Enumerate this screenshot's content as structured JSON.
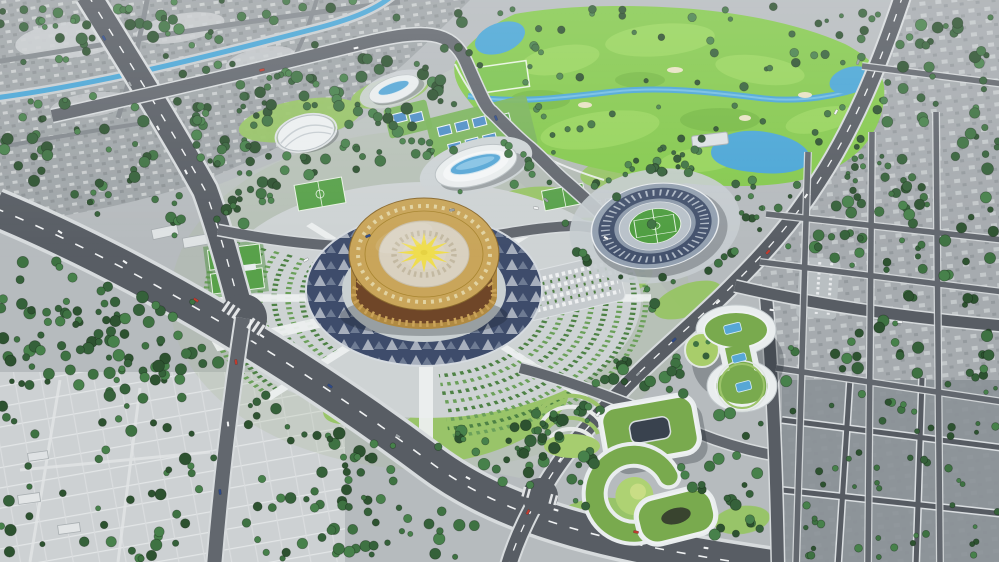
{
  "meta": {
    "kind": "aerial-architectural-render",
    "description": "Bird's-eye 3D masterplan render: central golden circular arena with sunburst roof on a radial plaza of arc-shaped tree gardens, athletics stadium, oval aquatics hall, golf course with stream and ponds, green-roof civic campus, wide boulevards, dense tree-lined city grid",
    "width": 999,
    "height": 562
  },
  "visible_text": [],
  "colors": {
    "ground": "#b6bbbe",
    "city_nw": "#9fa5a8",
    "city_right": "#a6abaf",
    "city_dark": "#8b9197",
    "plots": "#cdd1d3",
    "road": "#585d64",
    "road_minor": "#62676e",
    "road_edge": "#d7dbdd",
    "lane": "#f0f2f3",
    "tree1": "#2d5230",
    "tree2": "#35613a",
    "tree3": "#3e7242",
    "tree4": "#47814b",
    "lawn": "#97c465",
    "lawn_bright": "#aed273",
    "park": "#bcc3c0",
    "golf": "#85c94e",
    "golf_light": "#9bd75f",
    "water": "#4aa6d6",
    "water_light": "#7cc4e6",
    "plaza": "#ced3d4",
    "plaza_inner": "#c9d0d2",
    "navy": "#3e4c6b",
    "spoke": "#edf0f0",
    "arc_green": "#4e8245",
    "arena_gold": "#c9a55a",
    "arena_trim": "#e2d3a2",
    "arena_cream": "#d9d1c0",
    "arena_star": "#efdd4f",
    "arena_facade": "#b08a42",
    "arena_window": "#6f4628",
    "stadium_outer": "#93a0b0",
    "stadium_stand": "#44526d",
    "stadium_track": "#b9c2ca",
    "pitch": "#4f9e41",
    "bldg_white": "#e9edee",
    "glass": "#57a7d6",
    "green_roof": "#79aa4e",
    "court_blue": "#4f8fc7",
    "court_green": "#58a14a",
    "shadow": "rgba(25,32,40,0.28)"
  },
  "scene": {
    "landmarks": [
      {
        "id": "central-arena"
      },
      {
        "id": "radial-plaza-arc-gardens"
      },
      {
        "id": "athletics-stadium"
      },
      {
        "id": "aquatics-center"
      },
      {
        "id": "events-hall"
      },
      {
        "id": "dome-pavilion"
      },
      {
        "id": "golf-course"
      },
      {
        "id": "green-roof-campus"
      },
      {
        "id": "tennis-courts"
      },
      {
        "id": "soccer-fields"
      },
      {
        "id": "canal"
      },
      {
        "id": "boulevard"
      },
      {
        "id": "old-city-northwest"
      },
      {
        "id": "city-grid-right"
      },
      {
        "id": "vacant-plots-southwest"
      }
    ]
  }
}
